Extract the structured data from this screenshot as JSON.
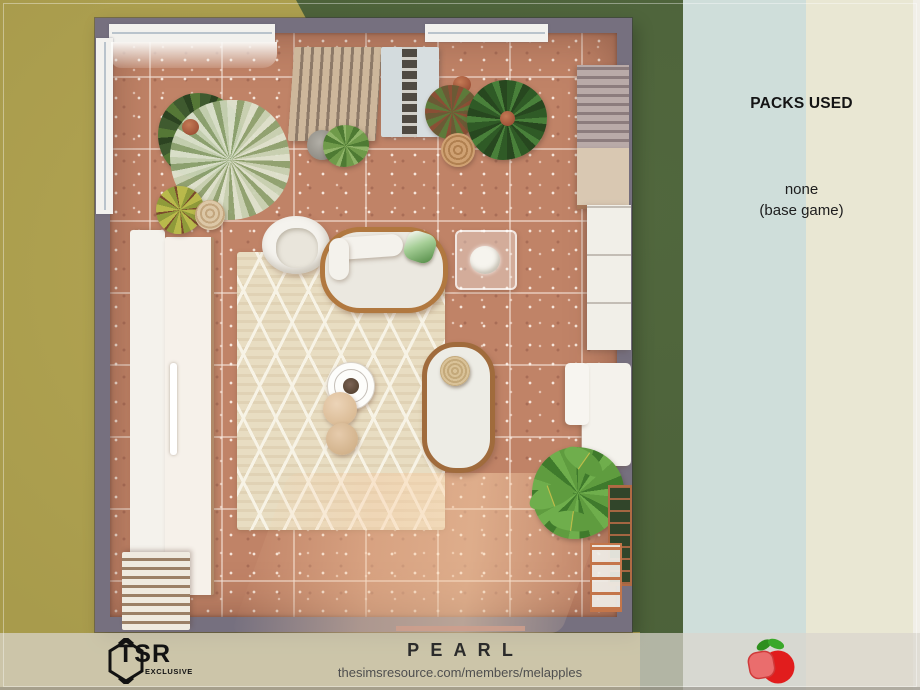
{
  "panel": {
    "heading": "PACKS USED",
    "line1": "none",
    "line2": "(base game)"
  },
  "footer": {
    "tsr_line1": "TSR",
    "tsr_line2": "EXCLUSIVE",
    "title": "PEARL",
    "url": "thesimsresource.com/members/melapples"
  },
  "scene": {
    "view": "top-down room screenshot",
    "icons": [
      "tsr-exclusive-logo",
      "melapples-apple-icon"
    ]
  },
  "colors": {
    "terrain_mustard": "#a89b4c",
    "grass_green": "#4c6139",
    "band_blue": "#cfdeda",
    "band_cream": "#e9e7d3",
    "wall_purple_gray": "#76707f",
    "floor_terracotta": "#c08367",
    "rug_beige": "#e8ddc2",
    "rattan": "#b1783f",
    "footer_overlay": "#dad6cd",
    "apple_red": "#e11d1d",
    "apple_slice_pink": "#ea6d6d",
    "leaf_green": "#2e8f1d",
    "text_dark": "#1d1d1d"
  }
}
